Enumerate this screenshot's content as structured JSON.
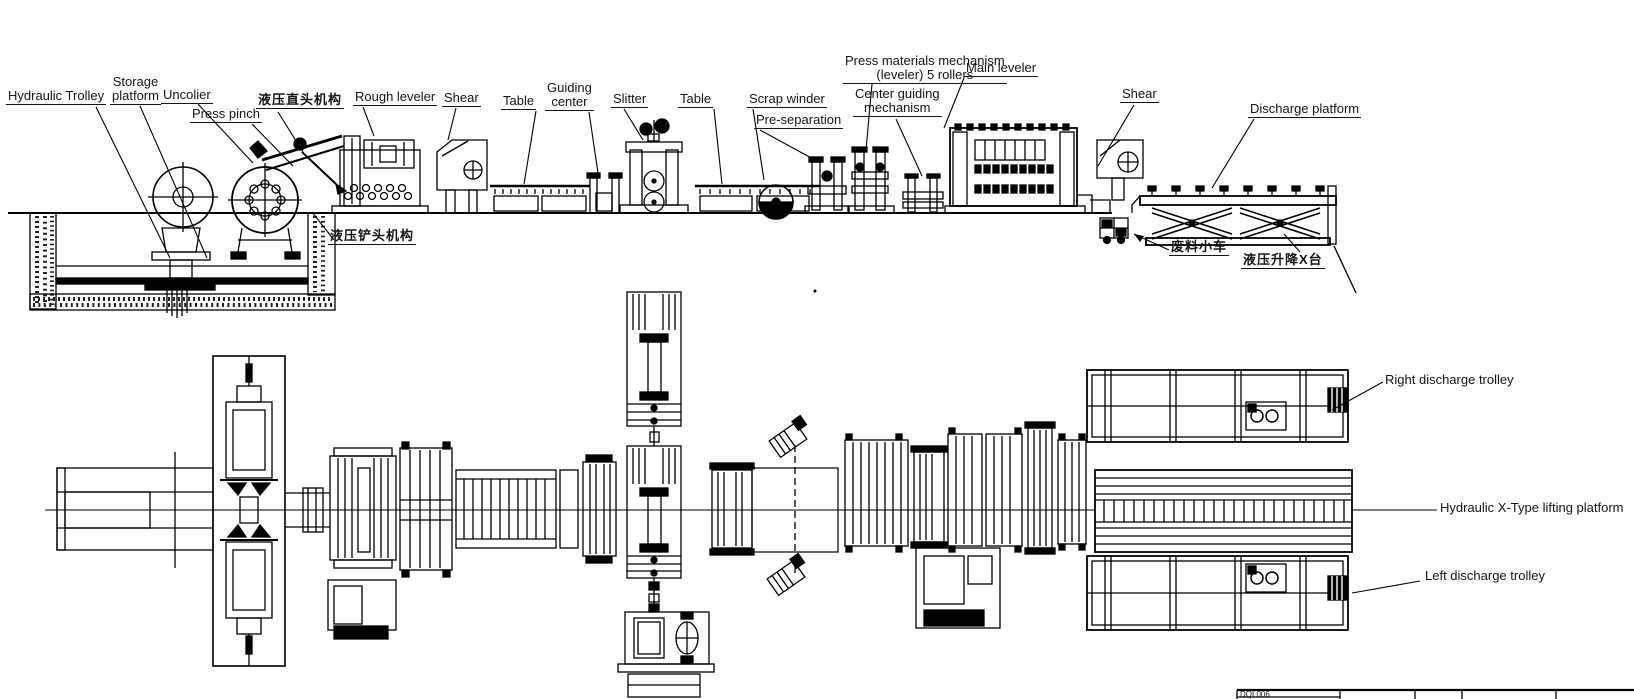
{
  "drawing": {
    "elevation_labels": {
      "hydraulic_trolley": "Hydraulic Trolley",
      "storage_platform": "Storage\nplatform",
      "uncolier": "Uncolier",
      "press_pinch": "Press pinch",
      "hydraulic_straight_head_cn": "液压直头机构",
      "rough_leveler": "Rough leveler",
      "shear_1": "Shear",
      "table_1": "Table",
      "guiding_center": "Guiding\ncenter",
      "slitter": "Slitter",
      "table_2": "Table",
      "scrap_winder": "Scrap winder",
      "pre_separation": "Pre-separation",
      "press_materials": "Press materials mechanism\n(leveler) 5 rollers",
      "main_leveler": "Main leveler",
      "center_guiding": "Center guiding\nmechanism",
      "shear_2": "Shear",
      "discharge_platform": "Discharge platform",
      "hydraulic_shovel_head_cn": "液压铲头机构",
      "scrap_trolley_cn": "废料小车",
      "lifting_platform_cn": "液压升降X台"
    },
    "plan_labels": {
      "right_discharge_trolley": "Right discharge trolley",
      "hydraulic_x_lifting_platform": "Hydraulic X-Type lifting platform",
      "left_discharge_trolley": "Left discharge trolley"
    },
    "titleblock": {
      "code": "DQL006"
    }
  }
}
